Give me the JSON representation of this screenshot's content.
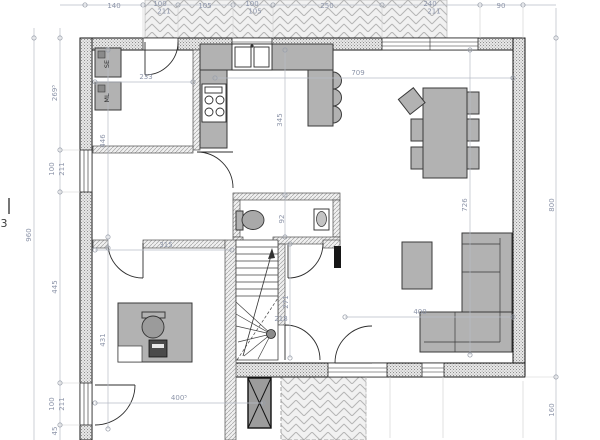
{
  "drawing": {
    "type": "house ground floor plan",
    "colors": {
      "dimension_text": "#8d95a9",
      "dimension_line": "#b7bcc6",
      "accent_dimension_text": "#b5703a",
      "wall_stroke": "#161616",
      "furniture_fill": "#b2b2b2",
      "background": "#ffffff"
    }
  },
  "dimension_labels": [
    {
      "t": "140",
      "x": 114,
      "y": 8
    },
    {
      "t": "100",
      "x": 160,
      "y": 6
    },
    {
      "t": "211",
      "x": 164,
      "y": 13.5
    },
    {
      "t": "105",
      "x": 205,
      "y": 8
    },
    {
      "t": "100",
      "x": 252,
      "y": 6
    },
    {
      "t": "105",
      "x": 255,
      "y": 13.5
    },
    {
      "t": "250",
      "x": 327,
      "y": 8
    },
    {
      "t": "240",
      "x": 430,
      "y": 6
    },
    {
      "t": "211",
      "x": 434,
      "y": 13.5
    },
    {
      "t": "90",
      "x": 501,
      "y": 8
    },
    {
      "t": "960",
      "x": 31,
      "y": 235,
      "rot": -90
    },
    {
      "t": "269⁵",
      "x": 57,
      "y": 93,
      "rot": -90
    },
    {
      "t": "100",
      "x": 54,
      "y": 169,
      "rot": -90
    },
    {
      "t": "211",
      "x": 64,
      "y": 169,
      "rot": -90
    },
    {
      "t": "445",
      "x": 57,
      "y": 287,
      "rot": -90
    },
    {
      "t": "100",
      "x": 54,
      "y": 404,
      "rot": -90
    },
    {
      "t": "211",
      "x": 64,
      "y": 404,
      "rot": -90
    },
    {
      "t": "45",
      "x": 57,
      "y": 431,
      "rot": -90
    },
    {
      "t": "726",
      "x": 467,
      "y": 205,
      "rot": -90
    },
    {
      "t": "800",
      "x": 554,
      "y": 205,
      "rot": -90
    },
    {
      "t": "160",
      "x": 554,
      "y": 410,
      "rot": -90
    },
    {
      "t": "233",
      "x": 146,
      "y": 79
    },
    {
      "t": "446",
      "x": 105,
      "y": 141,
      "rot": -90
    },
    {
      "t": "345",
      "x": 282,
      "y": 120,
      "rot": -90
    },
    {
      "t": "709",
      "x": 358,
      "y": 75
    },
    {
      "t": "92",
      "x": 284,
      "y": 219,
      "rot": -90
    },
    {
      "t": "271",
      "x": 288,
      "y": 302,
      "rot": -90
    },
    {
      "t": "218",
      "x": 281,
      "y": 321,
      "c": "#b5703a"
    },
    {
      "t": "315",
      "x": 166,
      "y": 247
    },
    {
      "t": "431",
      "x": 105,
      "y": 340,
      "rot": -90
    },
    {
      "t": "400",
      "x": 420,
      "y": 314
    },
    {
      "t": "400⁵",
      "x": 179,
      "y": 400
    }
  ],
  "annotations": [
    {
      "t": "SE",
      "x": 109,
      "y": 64,
      "rot": -90,
      "cls": "ann"
    },
    {
      "t": "ML",
      "x": 109,
      "y": 98,
      "rot": -90,
      "cls": "ann"
    },
    {
      "t": "3",
      "x": 4,
      "y": 227,
      "cls": "sec"
    }
  ]
}
